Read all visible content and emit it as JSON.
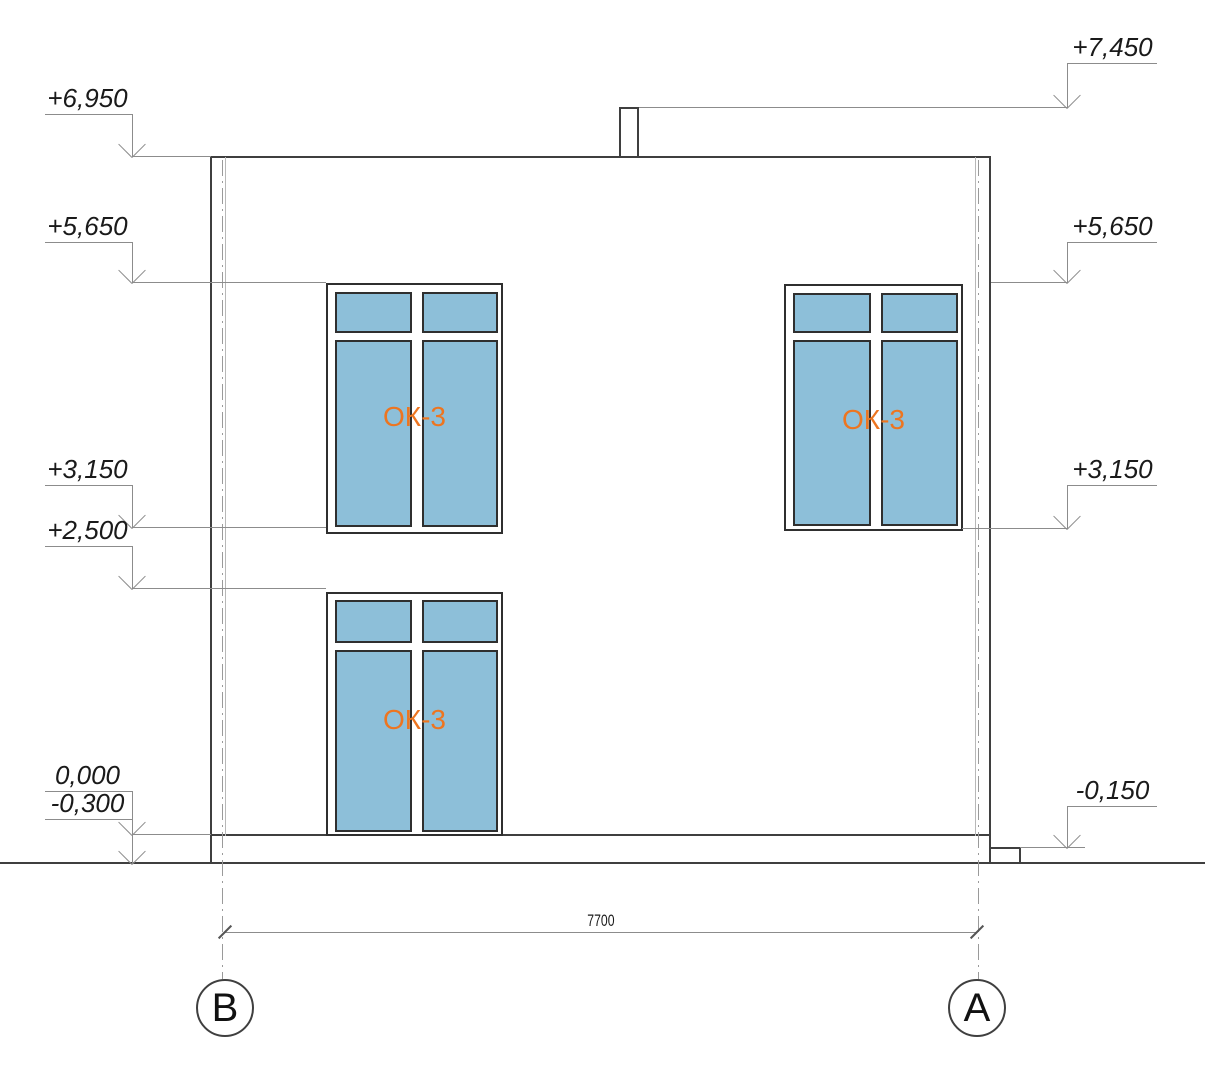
{
  "drawing": {
    "type": "building-elevation-section",
    "marks_left": [
      {
        "label": "+6,950"
      },
      {
        "label": "+5,650"
      },
      {
        "label": "+3,150"
      },
      {
        "label": "+2,500"
      },
      {
        "label": "0,000"
      },
      {
        "label": "-0,300"
      }
    ],
    "marks_right": [
      {
        "label": "+7,450"
      },
      {
        "label": "+5,650"
      },
      {
        "label": "+3,150"
      },
      {
        "label": "-0,150"
      }
    ],
    "windows": [
      {
        "label": "ОК-3"
      },
      {
        "label": "ОК-3"
      },
      {
        "label": "ОК-3"
      }
    ],
    "dimension": {
      "value": "7700"
    },
    "axes": {
      "left": "В",
      "right": "А"
    }
  },
  "colors": {
    "glass_blue": "#8dbfd9",
    "window_tag_orange": "#ed7520",
    "outline_dark": "#3f3f3f",
    "reference_gray": "#8c8c8c"
  }
}
